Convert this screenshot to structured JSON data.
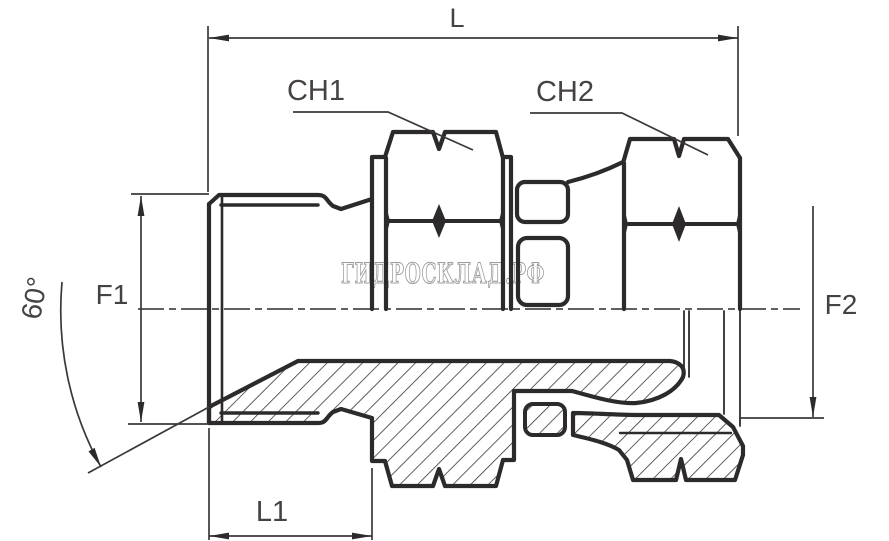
{
  "drawing": {
    "kind": "technical-drawing-half-section",
    "subject": "hydraulic adapter fitting with swivel nut",
    "background": "#ffffff",
    "line_color": "#2d2a2b",
    "label_color": "#464143",
    "labels": {
      "overall_length": "L",
      "hex1_wrench": "CH1",
      "hex2_wrench": "CH2",
      "left_thread_diameter": "F1",
      "right_thread_diameter": "F2",
      "stud_length": "L1",
      "cone_angle": "60°"
    },
    "watermark": {
      "text": "ГИДРОСКЛАД.РФ",
      "color": "#9c9c9c"
    }
  }
}
